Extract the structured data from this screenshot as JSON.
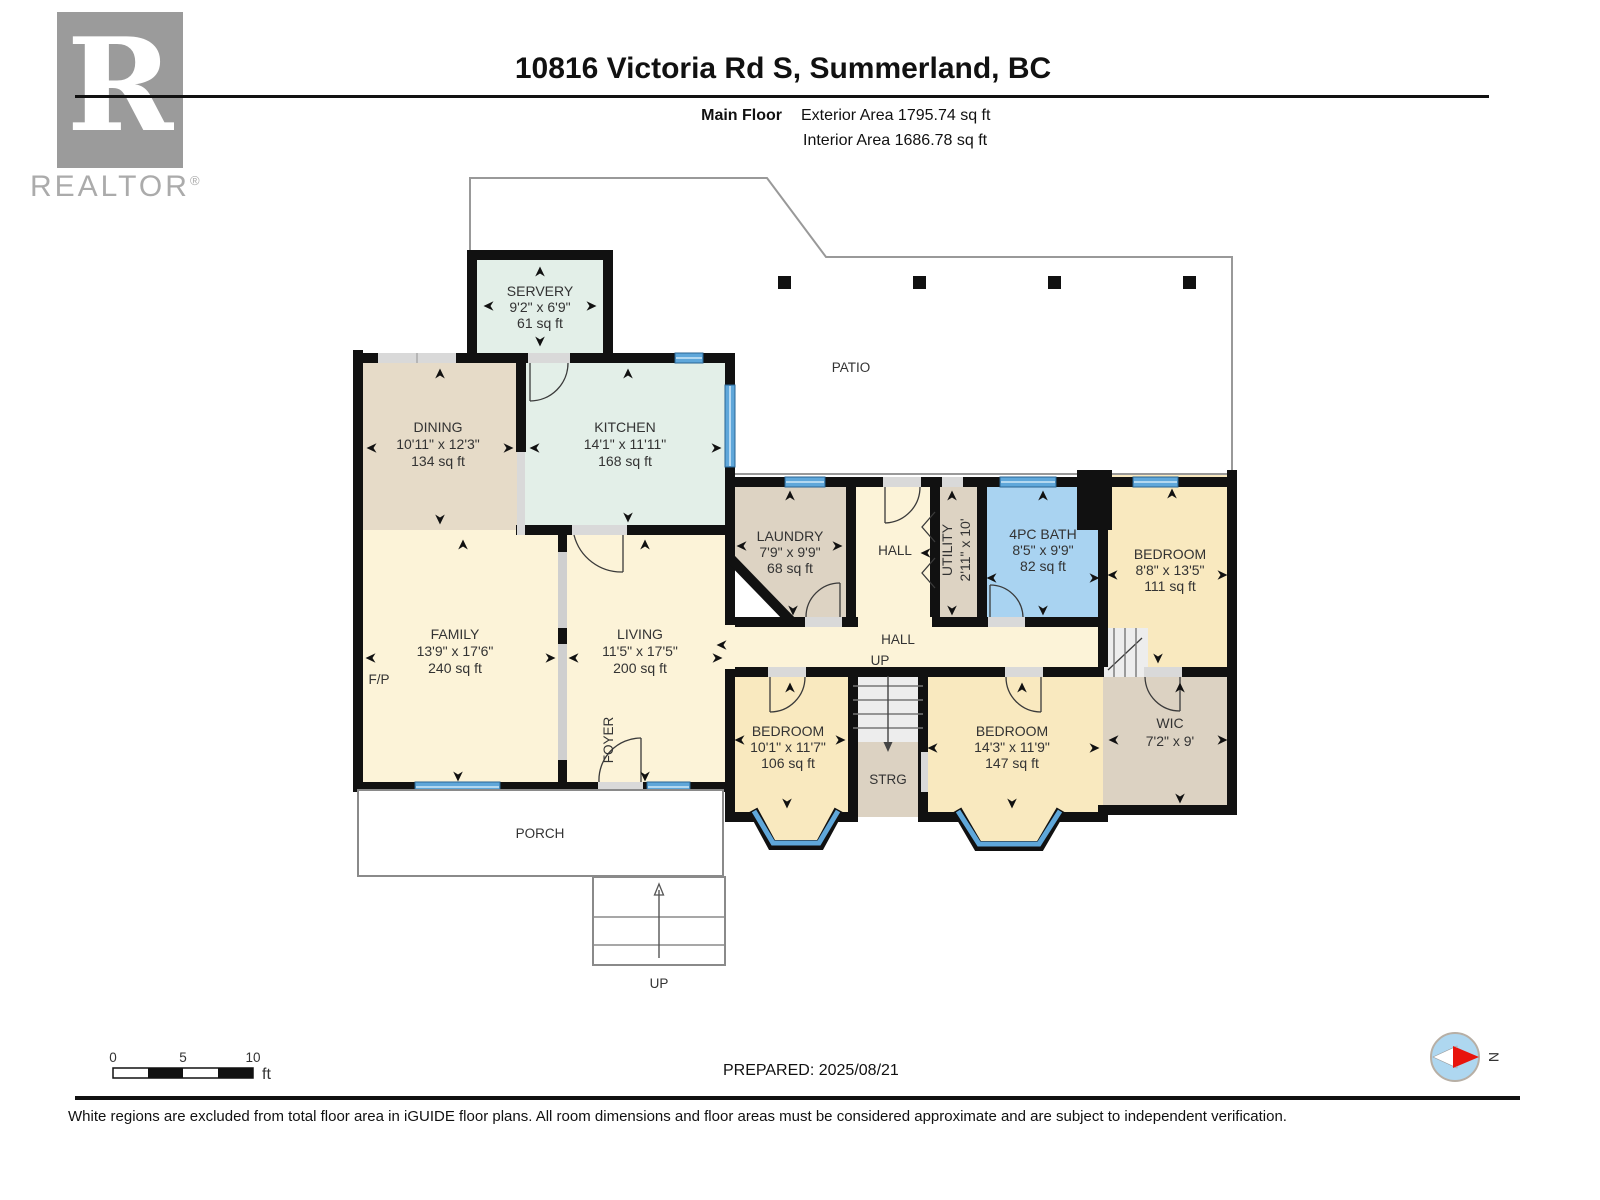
{
  "header": {
    "title": "10816 Victoria Rd S, Summerland, BC",
    "floor_label": "Main Floor",
    "exterior_area": "Exterior Area 1795.74 sq ft",
    "interior_area": "Interior Area 1686.78 sq ft"
  },
  "branding": {
    "logo_letter": "R",
    "logo_wordmark": "REALTOR",
    "registered_mark": "®"
  },
  "rooms": {
    "servery": {
      "name": "SERVERY",
      "dims": "9'2\" x 6'9\"",
      "area": "61 sq ft"
    },
    "dining": {
      "name": "DINING",
      "dims": "10'11\" x 12'3\"",
      "area": "134 sq ft"
    },
    "kitchen": {
      "name": "KITCHEN",
      "dims": "14'1\" x 11'11\"",
      "area": "168 sq ft"
    },
    "family": {
      "name": "FAMILY",
      "dims": "13'9\" x 17'6\"",
      "area": "240 sq ft"
    },
    "living": {
      "name": "LIVING",
      "dims": "11'5\" x 17'5\"",
      "area": "200 sq ft"
    },
    "laundry": {
      "name": "LAUNDRY",
      "dims": "7'9\" x 9'9\"",
      "area": "68 sq ft"
    },
    "utility": {
      "name": "UTILITY",
      "dims": "2'11\" x 10'"
    },
    "bath": {
      "name": "4PC BATH",
      "dims": "8'5\" x 9'9\"",
      "area": "82 sq ft"
    },
    "bedroom_ne": {
      "name": "BEDROOM",
      "dims": "8'8\" x 13'5\"",
      "area": "111 sq ft"
    },
    "bedroom_sw": {
      "name": "BEDROOM",
      "dims": "10'1\" x 11'7\"",
      "area": "106 sq ft"
    },
    "bedroom_se": {
      "name": "BEDROOM",
      "dims": "14'3\" x 11'9\"",
      "area": "147 sq ft"
    },
    "wic": {
      "name": "WIC",
      "dims": "7'2\" x 9'"
    }
  },
  "labels": {
    "patio": "PATIO",
    "porch": "PORCH",
    "hall_upper": "HALL",
    "hall_main": "HALL",
    "up_hall": "UP",
    "up_steps": "UP",
    "storage": "STRG",
    "fireplace": "F/P",
    "foyer": "FOYER"
  },
  "footer": {
    "scale_0": "0",
    "scale_5": "5",
    "scale_10": "10",
    "scale_unit": "ft",
    "prepared": "PREPARED: 2025/08/21",
    "compass_n": "N",
    "disclaimer": "White regions are excluded from total floor area in iGUIDE floor plans. All room dimensions and floor areas must be considered approximate and are subject to independent verification."
  },
  "colors": {
    "wall": "#111111",
    "cream_room": "#fcf3d8",
    "yellow_room": "#f9e9bf",
    "tan_room": "#e6dbc8",
    "mint_room": "#e3efe8",
    "gray_room": "#dcd2c2",
    "bath_blue": "#a9d3f1",
    "window_blue": "#5fa7da",
    "door_gray": "#d9d9d9",
    "outline_gray": "#999999",
    "compass_fill": "#aed7f0",
    "compass_needle": "#e8140c"
  }
}
